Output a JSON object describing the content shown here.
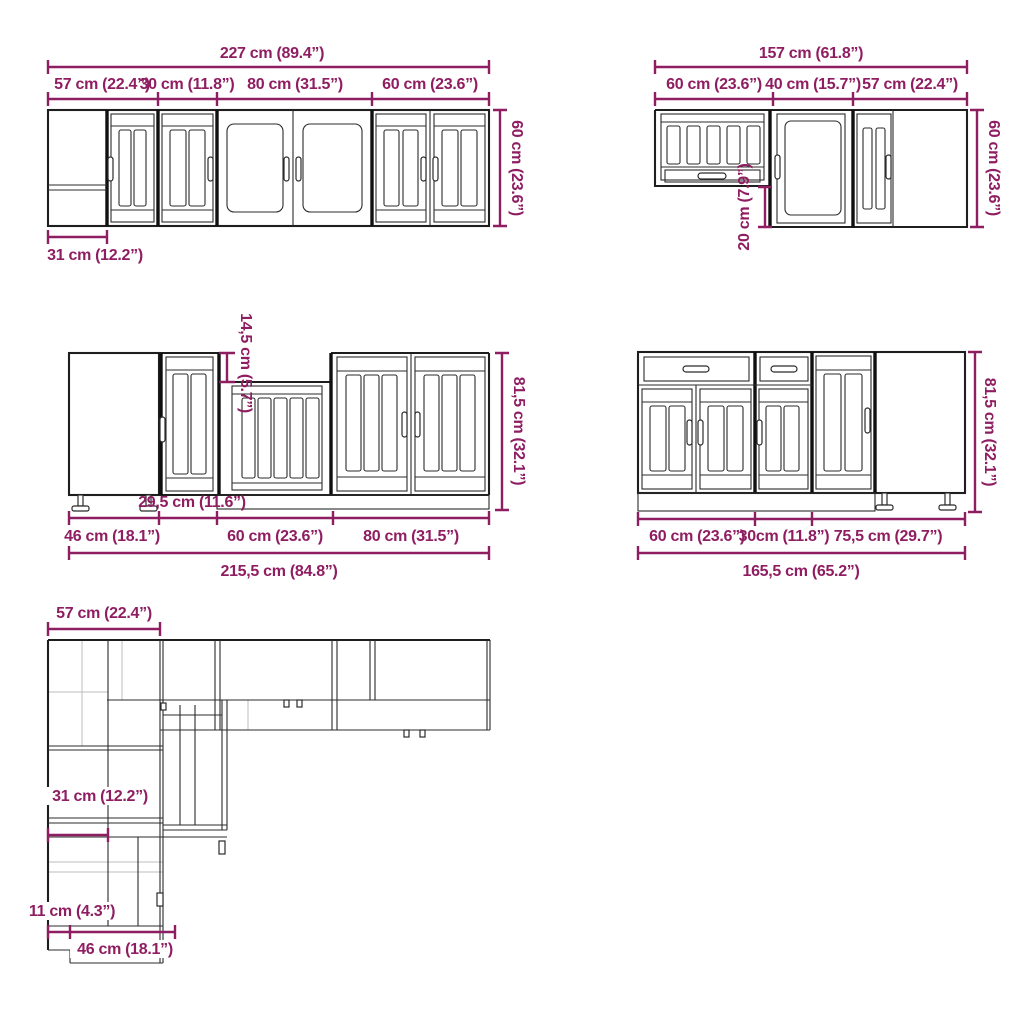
{
  "colors": {
    "dimension": "#8F1D61",
    "line": "#2b2b2b",
    "background": "#ffffff"
  },
  "figures": {
    "wall_run_left": {
      "total": "227 cm (89.4”)",
      "segments": [
        "57 cm (22.4”)",
        "30 cm (11.8”)",
        "80 cm (31.5”)",
        "60 cm (23.6”)"
      ],
      "height": "60 cm (23.6”)",
      "corner_depth": "31 cm (12.2”)"
    },
    "wall_run_right": {
      "total": "157 cm (61.8”)",
      "segments": [
        "60 cm (23.6”)",
        "40 cm (15.7”)",
        "57 cm (22.4”)"
      ],
      "height": "60 cm (23.6”)",
      "hood_offset": "20 cm (7.9”)"
    },
    "base_run_left": {
      "total": "215,5 cm (84.8”)",
      "segments": [
        "46 cm (18.1”)",
        "29,5 cm (11.6”)",
        "60 cm (23.6”)",
        "80 cm (31.5”)"
      ],
      "height": "81,5 cm (32.1”)",
      "sink_recess": "14,5 cm (5.7”)"
    },
    "base_run_right": {
      "total": "165,5 cm (65.2”)",
      "segments": [
        "60 cm (23.6”)",
        "30cm (11.8”)",
        "75,5 cm (29.7”)"
      ],
      "height": "81,5 cm (32.1”)"
    },
    "plan_view": {
      "corner_width": "57 cm (22.4”)",
      "wall_depth": "31 cm (12.2”)",
      "filler": "11 cm (4.3”)",
      "base_depth": "46 cm (18.1”)"
    }
  }
}
